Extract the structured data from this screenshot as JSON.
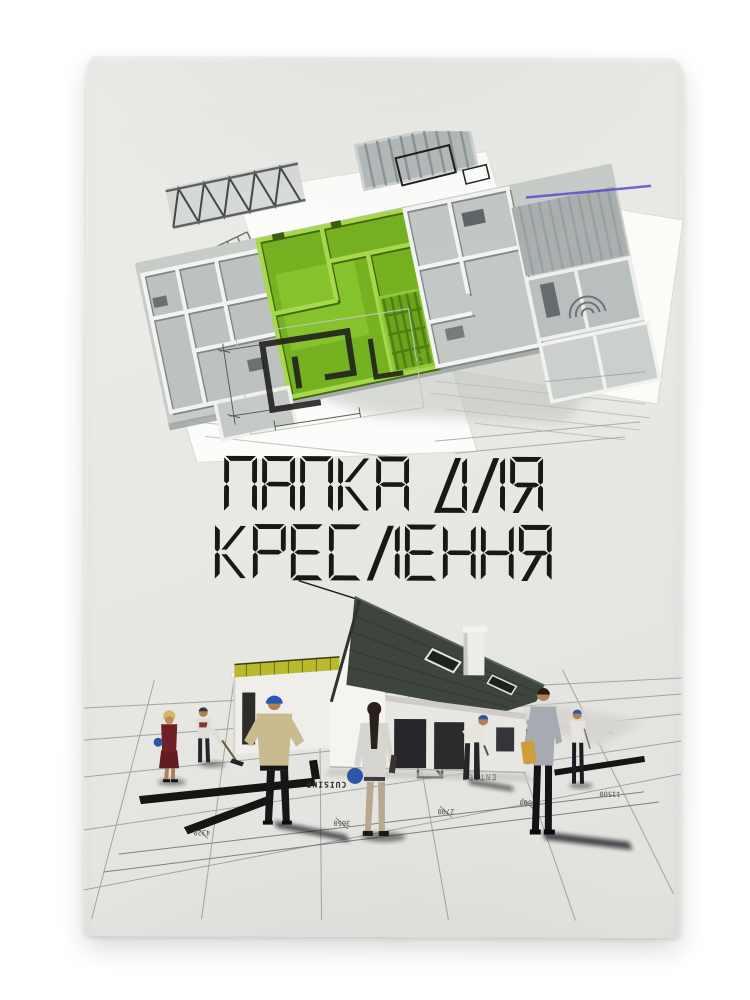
{
  "product": {
    "kind": "drawing-folder-cover-photo",
    "title": {
      "line1": "ПАПКА ДЛЯ",
      "line2": "КРЕСЛЕННЯ"
    }
  },
  "artwork": {
    "blueprint_labels": {
      "cuisine": "CUISINE",
      "entree": "ENTREE"
    },
    "dimensions": [
      "4320",
      "3650",
      "2700",
      "5600",
      "11500"
    ]
  },
  "colors": {
    "backdrop": "#ffffff",
    "paper": "#e8e8e4",
    "title_text": "#181817",
    "accent_green": "#76b122",
    "roof_dark": "#3e453c",
    "hardhat_blue": "#2e56a6",
    "glass_yellow": "#b9b92e"
  }
}
